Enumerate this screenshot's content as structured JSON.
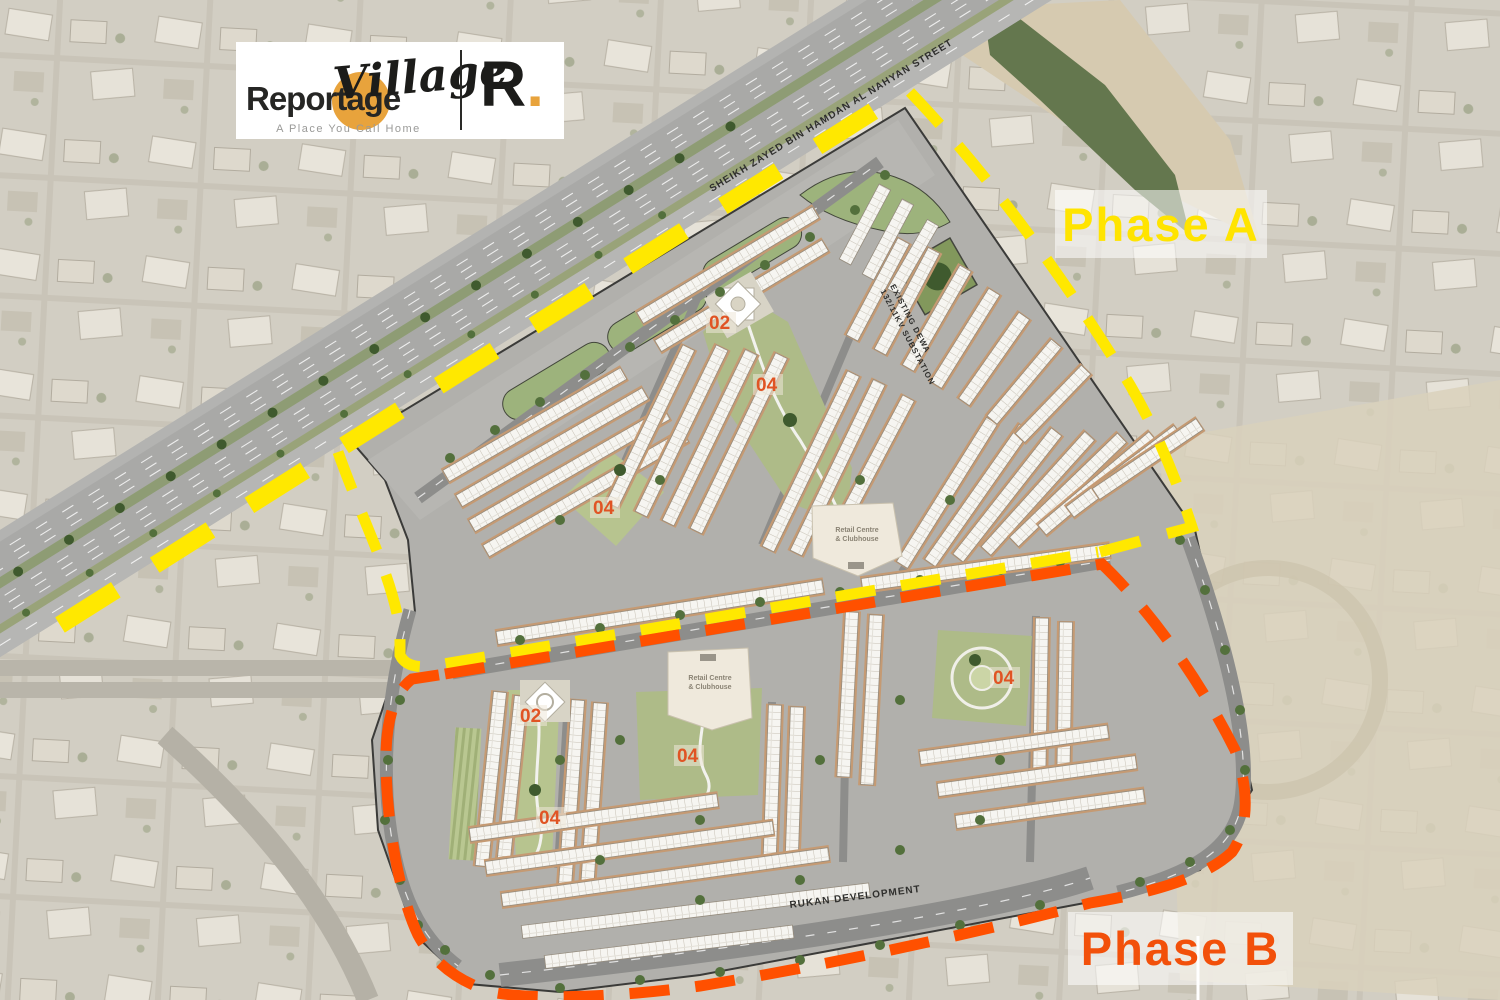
{
  "branding": {
    "logo_text_bold": "Reportage",
    "logo_text_script": "Village",
    "logo_tagline": "A Place You Call Home",
    "logo_monogram": "R",
    "logo_monogram_dot": ".",
    "logo_accent_color": "#E8A33C"
  },
  "phase_a": {
    "label": "Phase A",
    "text_color": "#FFE400",
    "boundary_color": "#FFE800"
  },
  "phase_b": {
    "label": "Phase B",
    "text_color": "#F2500A",
    "boundary_color": "#FF5000"
  },
  "map_labels": {
    "highway": "SHEIKH ZAYED BIN HAMDAN AL NAHYAN STREET",
    "south_road": "RUKAN DEVELOPMENT",
    "substation_line1": "EXISTING DEWA",
    "substation_line2": "132/11KV SUBSTATION",
    "retail_a_line1": "Retail Centre",
    "retail_a_line2": "& Clubhouse",
    "retail_b_line1": "Retail Centre",
    "retail_b_line2": "& Clubhouse"
  },
  "plot_labels": {
    "a_mosque": "02",
    "a_park_left": "04",
    "a_park_main": "04",
    "b_mosque": "02",
    "b_park_left": "04",
    "b_park_mid": "04",
    "b_park_right": "04"
  }
}
